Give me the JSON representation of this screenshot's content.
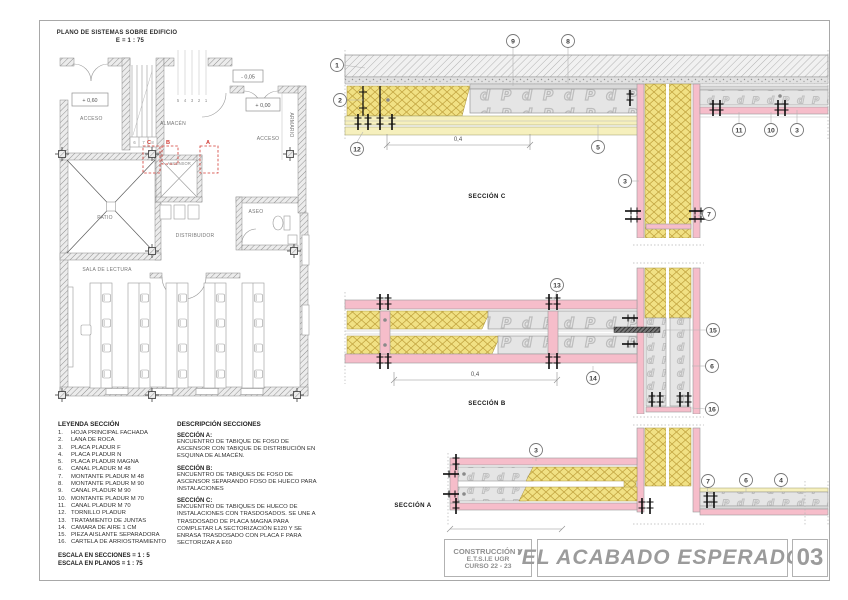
{
  "plan": {
    "title": "PLANO DE SISTEMAS SOBRE EDIFICIO",
    "scale": "E = 1 : 75",
    "levels": {
      "left": "+ 0,60",
      "right": "+ 0,00",
      "entry": "- 0,05"
    },
    "rooms": {
      "acceso_left": "ACCESO",
      "almacen": "ALMACÉN",
      "acceso_right": "ACCESO",
      "armario": "ARMARIO",
      "ascensor": "ASCENSOR",
      "patio": "PATIO",
      "distribuidor": "DISTRIBUIDOR",
      "aseo": "ASEO",
      "sala": "SALA DE LECTURA"
    },
    "section_markers": {
      "a": "A",
      "b": "B",
      "c": "C"
    },
    "stair_numbers": {
      "s6": "6",
      "s7": "7",
      "s8": "8"
    },
    "riser_numbers": {
      "r5": "5",
      "r4": "4",
      "r3": "3",
      "r2": "2",
      "r1": "1"
    }
  },
  "sections": {
    "c": {
      "label": "SECCIÓN C",
      "dimension": "0,4"
    },
    "b": {
      "label": "SECCIÓN B",
      "dimension": "0,4"
    },
    "a": {
      "label": "SECCIÓN A"
    }
  },
  "callouts": {
    "c_1": "1",
    "c_2": "2",
    "c_12": "12",
    "c_9": "9",
    "c_8": "8",
    "c_5": "5",
    "c_11": "11",
    "c_10": "10",
    "c_3r": "3",
    "w_3": "3",
    "w_7": "7",
    "b_13": "13",
    "b_14": "14",
    "b_15": "15",
    "b_6": "6",
    "b_16": "16",
    "a_3": "3",
    "a_7": "7",
    "a_6": "6",
    "a_4": "4"
  },
  "legend": {
    "title": "LEYENDA SECCIÓN",
    "items": [
      {
        "num": "1.",
        "label": "HOJA PRINCIPAL FACHADA"
      },
      {
        "num": "2.",
        "label": "LANA DE ROCA"
      },
      {
        "num": "3.",
        "label": "PLACA PLADUR F"
      },
      {
        "num": "4.",
        "label": "PLACA PLADUR N"
      },
      {
        "num": "5.",
        "label": "PLACA PLADUR MAGNA"
      },
      {
        "num": "6.",
        "label": "CANAL PLADUR M 48"
      },
      {
        "num": "7.",
        "label": "MONTANTE PLADUR M 48"
      },
      {
        "num": "8.",
        "label": "MONTANTE PLADUR M 90"
      },
      {
        "num": "9.",
        "label": "CANAL PLADUR M 90"
      },
      {
        "num": "10.",
        "label": "MONTANTE PLADUR M 70"
      },
      {
        "num": "11.",
        "label": "CANAL PLADUR M 70"
      },
      {
        "num": "12.",
        "label": "TORNILLO PLADUR"
      },
      {
        "num": "13.",
        "label": "TRATAMIENTO DE JUNTAS"
      },
      {
        "num": "14.",
        "label": "CAMARA DE AIRE 1 CM"
      },
      {
        "num": "15.",
        "label": "PIEZA AISLANTE SEPARADORA"
      },
      {
        "num": "16.",
        "label": "CARTELA DE ARRIOSTRAMIENTO"
      }
    ],
    "scale_sections": "ESCALA EN SECCIONES = 1 : 5",
    "scale_plans": "ESCALA EN PLANOS = 1 : 75"
  },
  "description": {
    "title": "DESCRIPCIÓN SECCIONES",
    "blocks": [
      {
        "heading": "SECCIÓN A:",
        "body": "ENCUENTRO DE TABIQUE DE FOSO DE ASCENSOR CON TABIQUE DE DISTRIBUCIÓN EN ESQUINA DE ALMACÉN."
      },
      {
        "heading": "SECCIÓN B:",
        "body": "ENCUENTRO DE TABIQUES DE FOSO DE ASCENSOR SEPARANDO FOSO DE HUECO PARA INSTALACIONES"
      },
      {
        "heading": "SECCIÓN C:",
        "body": "ENCUENTRO DE TABIQUES DE HUECO DE INSTALACIONES CON TRASDOSADOS. SE UNE A TRASDOSADO DE PLACA MAGNA PARA COMPLETAR LA SECTORIZACIÓN E120 Y SE ENRASA TRASDOSADO CON PLACA F PARA SECTORIZAR A E60"
      }
    ]
  },
  "titleblock": {
    "org": [
      "CONSTRUCCIÓN V",
      "E.T.S.I.E UGR",
      "CURSO 22 - 23"
    ],
    "title": "'EL ACABADO ESPERADO'",
    "sheet_number": "03"
  },
  "colors": {
    "insulation_yellow": "#f0e186",
    "board_gray": "#e5e5e5",
    "plasterboard_pink": "#f6bdca",
    "board_pale_yellow": "#f6f0bd",
    "marker_red": "#d23b34",
    "titleblock_gray": "#9b9b9b"
  }
}
